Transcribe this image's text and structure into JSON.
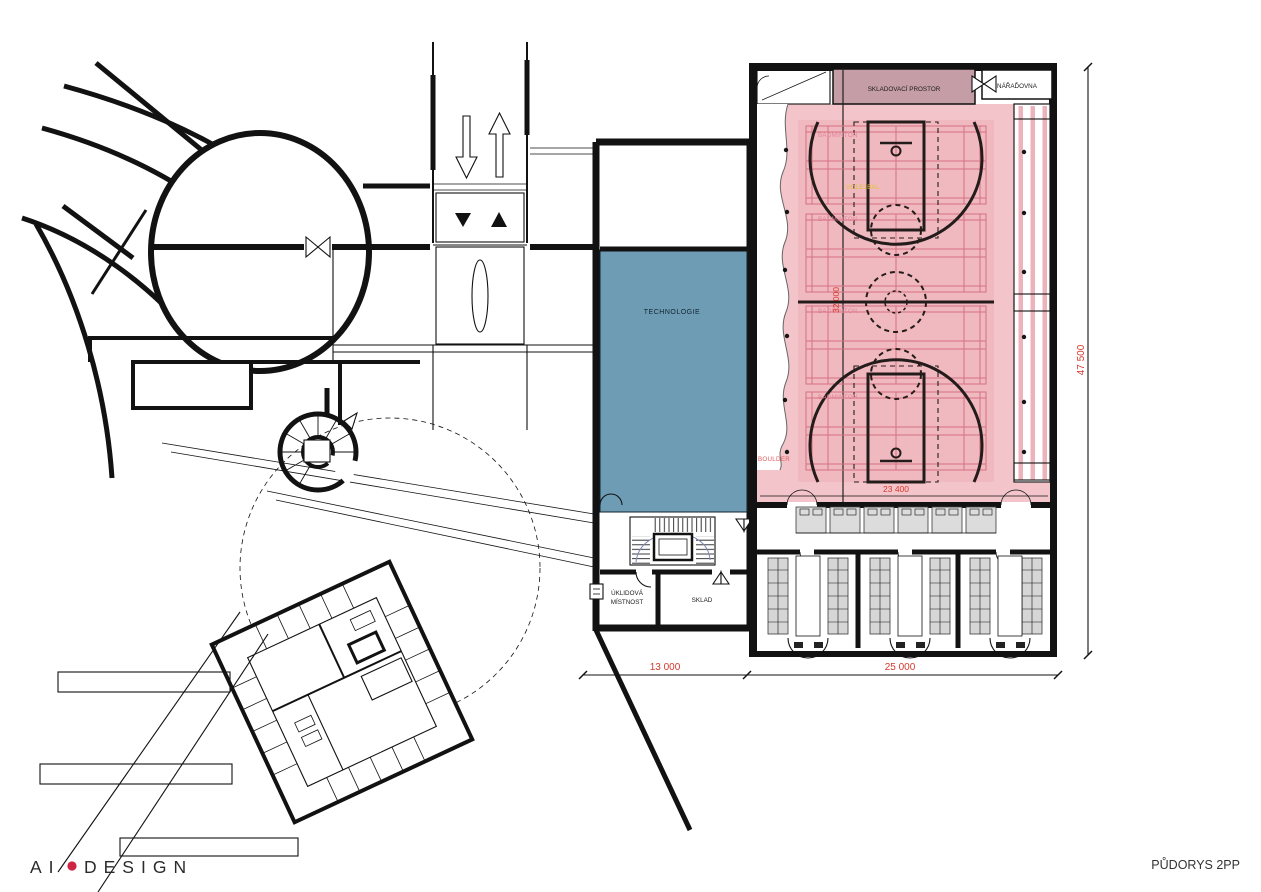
{
  "drawing": {
    "title": "PŮDORYS 2PP",
    "logo": {
      "part_a": "AI",
      "part_b": "DESIGN"
    }
  },
  "rooms": {
    "technologie": "TECHNOLOGIE",
    "skladovaci_prostor": "SKLADOVACÍ PROSTOR",
    "naradovna": "NÁŘAĎOVNA",
    "uklidova_line1": "ÚKLIDOVÁ",
    "uklidova_line2": "MÍSTNOST",
    "sklad": "SKLAD"
  },
  "hall": {
    "badminton_label": "BADMINTON",
    "volejbal_label": "VOLEJBAL",
    "boulder_label": "BOULDER"
  },
  "dimensions": {
    "span_left": "13 000",
    "span_hall": "25 000",
    "height_total": "47 500",
    "court_width": "23 400",
    "hall_inner": "32 000"
  },
  "colors": {
    "hall_pink": "#f3c5ca",
    "court_pink": "#f0b9c0",
    "storage_mauve": "#c59da6",
    "tech_blue": "#6d9cb4",
    "dim_red": "#d6382c",
    "badminton_label": "#e2849b",
    "volejbal_yellow": "#e0c22e",
    "boulder_red": "#e05a60",
    "logo_dot": "#ce2342"
  }
}
